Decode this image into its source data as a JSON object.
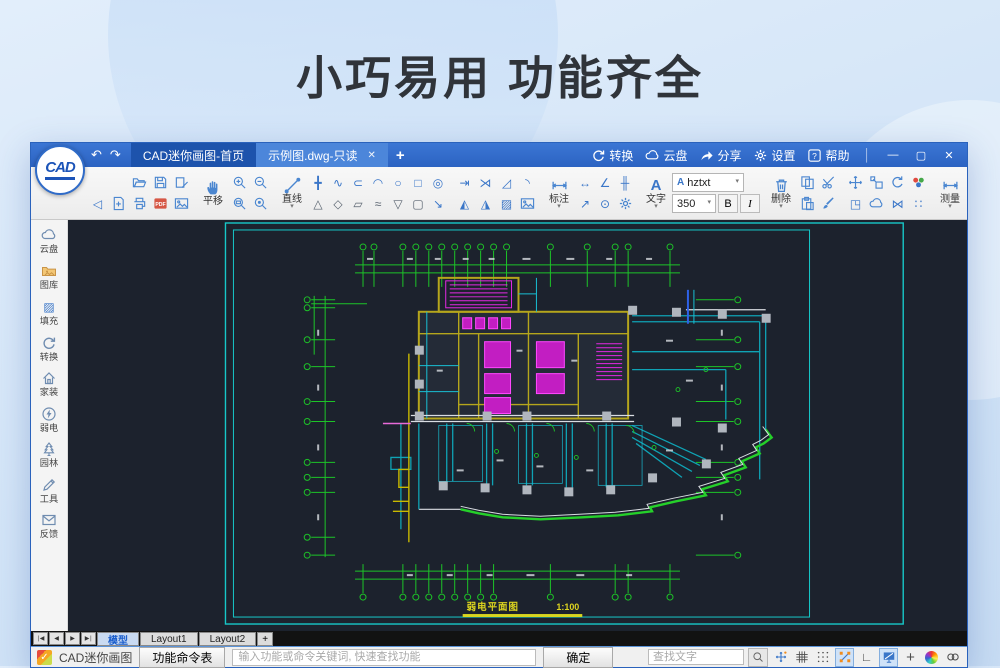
{
  "banner": {
    "title": "小巧易用 功能齐全"
  },
  "titlebar": {
    "logo": "CAD",
    "home_tab": "CAD迷你画图-首页",
    "doc_tab": "示例图.dwg-只读",
    "menu": {
      "convert": "转换",
      "cloud": "云盘",
      "share": "分享",
      "settings": "设置",
      "help": "帮助"
    }
  },
  "toolbar": {
    "pan": "平移",
    "line": "直线",
    "dim": "标注",
    "text": "文字",
    "del": "删除",
    "measure": "测量",
    "layer": "图层",
    "color": "颜色",
    "font_name": "hztxt",
    "font_size": "350",
    "bold": "B",
    "italic": "I"
  },
  "sidebar": {
    "items": [
      {
        "label": "云盘"
      },
      {
        "label": "图库"
      },
      {
        "label": "填充"
      },
      {
        "label": "转换"
      },
      {
        "label": "家装"
      },
      {
        "label": "弱电"
      },
      {
        "label": "园林"
      },
      {
        "label": "工具"
      },
      {
        "label": "反馈"
      }
    ]
  },
  "canvas": {
    "drawing_title": "弱电平面图",
    "drawing_scale": "1:100"
  },
  "model_tabs": {
    "model": "模型",
    "layout1": "Layout1",
    "layout2": "Layout2",
    "add": "+"
  },
  "statusbar": {
    "app_name": "CAD迷你画图",
    "command_button": "功能命令表",
    "command_placeholder": "输入功能或命令关键词, 快速查找功能",
    "ok": "确定",
    "find_placeholder": "查找文字"
  },
  "icons": {
    "back": "↶",
    "forward": "↷",
    "tab_close": "✕",
    "tab_add": "+",
    "win_min": "—",
    "win_max": "▢",
    "win_close": "✕",
    "menu_sep": "│",
    "undo_step": "◁",
    "construction": "╋",
    "polyline": "∿",
    "offset": "⊂",
    "arc": "◠",
    "circle": "○",
    "rect": "□",
    "ellipse": "◎",
    "triangle": "△",
    "pentagon": "◇",
    "parallelogram": "▱",
    "spline": "≈",
    "trapezoid": "▽",
    "rounded_rect": "▢",
    "arrow_line": "↘",
    "trim": "⇥",
    "break": "⋊",
    "chamfer": "◿",
    "fillet": "◝",
    "polygon_a": "◭",
    "polygon_b": "◮",
    "hatch": "▨",
    "dim_aligned": "↔",
    "dim_angle": "∠",
    "dim_linear": "╫",
    "dim_leader": "↗",
    "dim_radius": "⊙",
    "text_a": "A",
    "area": "▭",
    "calc": "⊞",
    "table": "▦",
    "mirror": "⋈",
    "rotate_ref": "◳",
    "array": "∷",
    "lines_solid": "≡",
    "lines_dash": "≡",
    "ortho": "∟",
    "crosshair": "+",
    "caret": "▾",
    "nav_first": "∣◀",
    "nav_prev": "◀",
    "nav_next": "▶",
    "nav_last": "▶∣",
    "check": "✓"
  },
  "colors": {
    "titlebar": "#2e68c6",
    "active_tab": "#4c86da",
    "home_tab": "#1d53ac",
    "canvas_bg": "#1c222d",
    "frame_cyan": "#17c8c8",
    "axis_green": "#1dc428",
    "wall_olive": "#b5a61c",
    "block_magenta": "#e429e4",
    "wall_teal": "#19bfd4",
    "boundary_green": "#25d02a",
    "label_yellow": "#ded51f",
    "palette": [
      "#ffffff",
      "#e8401c",
      "#f5e616",
      "#8cc63f",
      "#111111",
      "#29abe2",
      "#39b54a",
      "#7d3f98"
    ]
  }
}
